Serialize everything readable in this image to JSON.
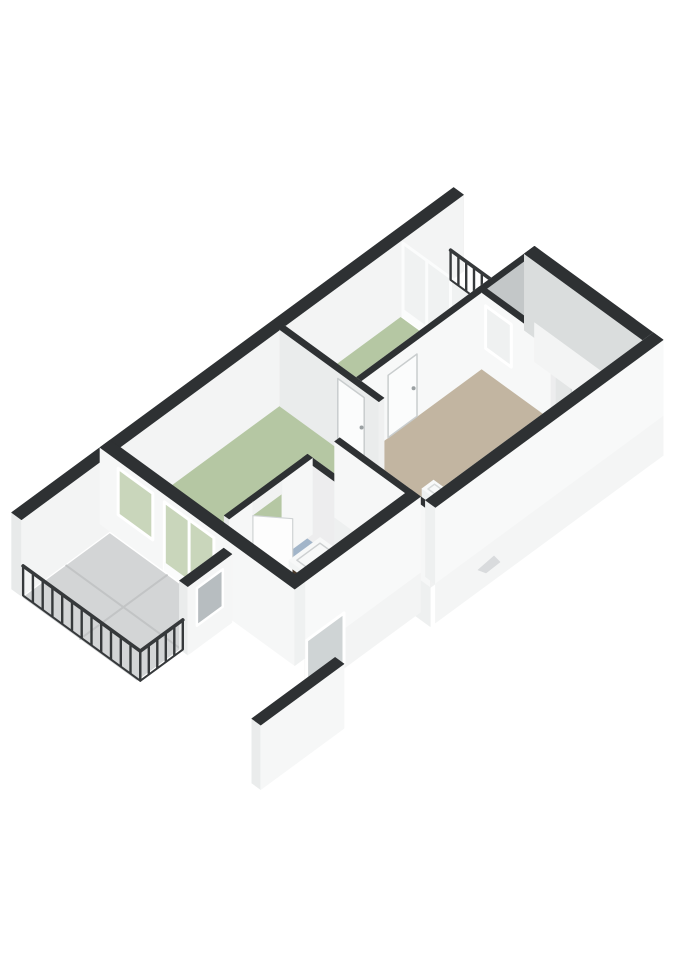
{
  "meta": {
    "description": "3D isometric floor plan render of an apartment, no text labels",
    "canvas": {
      "width": 679,
      "height": 960
    },
    "background": "#ffffff"
  },
  "palette": {
    "wall_top_dark": "#2e3133",
    "wall_white": "#f7f8f8",
    "wall_shadow": "#c3c7c8",
    "floor_green": "#b5c7a3",
    "floor_green_dark": "#aec29c",
    "floor_blue": "#a2b5c9",
    "floor_tan": "#c2b5a1",
    "floor_tile_gray": "#d3d5d6",
    "glass_green": "#c9d6bb",
    "railing_dark": "#36393b",
    "cabinet_brown": "#3b2f24",
    "fixture_white": "#f2f4f4"
  },
  "rooms": [
    {
      "id": "living-room",
      "floor_color": "#b5c7a3"
    },
    {
      "id": "bedroom-middle",
      "floor_color": "#b5c7a3"
    },
    {
      "id": "bedroom-right",
      "floor_color": "#b5c7a3"
    },
    {
      "id": "hallway",
      "floor_color": "#c2b5a1"
    },
    {
      "id": "bathroom",
      "floor_color": "#a2b5c9"
    },
    {
      "id": "balcony-southwest",
      "floor_color": "#d3d5d6"
    },
    {
      "id": "balcony-north",
      "floor_color": "#dcdedd"
    }
  ],
  "projection": {
    "ox": 100,
    "oy": 524,
    "u": [
      34,
      -25
    ],
    "v": [
      33,
      24
    ],
    "z": 30
  },
  "scene": [
    {
      "t": "wall",
      "name": "nw-facade-wall",
      "u": [
        -2.6,
        10.4
      ],
      "v": [
        0,
        0.3
      ],
      "z": [
        0,
        2.55
      ],
      "f": {
        "se": "#f3f4f4",
        "sw": "#e8eaea",
        "ne": "#dfe2e3",
        "top": "#2e3133"
      }
    },
    {
      "t": "floor",
      "name": "balcony-north-floor",
      "rect": [
        8.7,
        0.3,
        10.05,
        2.45
      ],
      "fill": "#dcdedd"
    },
    {
      "t": "floor",
      "name": "bedroom-middle-floor",
      "rect": [
        5.3,
        0.3,
        8.55,
        2.45
      ],
      "fill": "#b5c7a3"
    },
    {
      "t": "floor",
      "name": "bedroom-right-floor",
      "rect": [
        8.85,
        2.6,
        10.1,
        4.55
      ],
      "fill": "#b5c7a3"
    },
    {
      "t": "floor",
      "name": "living-room-floor",
      "rect": [
        0.3,
        0.3,
        5.0,
        3.3
      ],
      "fill": "#b5c7a3"
    },
    {
      "t": "floor",
      "name": "living-strip-floor",
      "rect": [
        2.9,
        3.3,
        3.55,
        5.6
      ],
      "fill": "#aec29c"
    },
    {
      "t": "floor",
      "name": "hallway-floor",
      "pts": [
        [
          5.1,
          2.6
        ],
        [
          8.7,
          2.6
        ],
        [
          8.7,
          6.05
        ],
        [
          3.7,
          6.05
        ],
        [
          3.7,
          3.45
        ],
        [
          5.1,
          3.45
        ]
      ],
      "fill": "#c2b5a1"
    },
    {
      "t": "floor",
      "name": "closet-floor",
      "rect": [
        8.85,
        4.7,
        10.1,
        6.05
      ],
      "fill": "#d0d2d1"
    },
    {
      "t": "floor",
      "name": "balcony-sw-floor",
      "rect": [
        -2.6,
        0.35,
        -0.05,
        3.8
      ],
      "fill": "#d3d5d6"
    },
    {
      "t": "line3",
      "name": "balcony-tile-seam-1",
      "pts": [
        [
          -1.33,
          0.35,
          0
        ],
        [
          -1.33,
          3.8,
          0
        ]
      ],
      "stroke": "#c2c4c5",
      "w": 2
    },
    {
      "t": "line3",
      "name": "balcony-tile-seam-2",
      "pts": [
        [
          -2.6,
          2.08,
          0
        ],
        [
          -0.05,
          2.08,
          0
        ]
      ],
      "stroke": "#c2c4c5",
      "w": 2
    },
    {
      "t": "floor",
      "name": "bathroom-floor",
      "rect": [
        0.45,
        3.45,
        2.75,
        5.6
      ],
      "fill": "#a2b5c9"
    },
    {
      "t": "floor",
      "name": "duct-shaft",
      "pts": [
        [
          2.3,
          4.05
        ],
        [
          2.75,
          4.05
        ],
        [
          2.75,
          4.6
        ],
        [
          2.05,
          4.6
        ],
        [
          2.05,
          4.32
        ],
        [
          2.3,
          4.32
        ]
      ],
      "fill": "#2e3133"
    },
    {
      "t": "glasswall",
      "name": "glazed-wall-middle-bedroom",
      "plane": "u",
      "at": 8.62,
      "r": [
        0.3,
        2.45
      ],
      "z": [
        0,
        2.42
      ],
      "fill": "#f0f2f2",
      "frame": "#fbfcfc",
      "mull": [
        1.02,
        1.74
      ],
      "base": 0.22
    },
    {
      "t": "rail",
      "name": "balcony-north-railing",
      "a": [
        10.0,
        0.32
      ],
      "b": [
        10.0,
        2.45
      ],
      "h": 1.05,
      "posts": 9,
      "color": "#36393b"
    },
    {
      "t": "wall",
      "name": "bedroom-right-nw-wall",
      "u": [
        8.7,
        10.4
      ],
      "v": [
        2.45,
        2.6
      ],
      "z": [
        0,
        2.55
      ],
      "f": {
        "nw": "#f4f5f5",
        "se": "#c3c7c8",
        "top": "#2e3133"
      }
    },
    {
      "t": "wall",
      "name": "bedroom-right-sw-wall",
      "u": [
        8.7,
        8.85
      ],
      "v": [
        2.45,
        4.7
      ],
      "z": [
        0,
        2.55
      ],
      "f": {
        "sw": "#f7f8f8",
        "top": "#2e3133"
      }
    },
    {
      "t": "win",
      "name": "bedroom-right-window",
      "plane": "u",
      "at": 8.7,
      "r": [
        2.72,
        3.5
      ],
      "z": [
        0.78,
        2.2
      ],
      "fill": "#eff1f1",
      "frame": "#ffffff",
      "fw": 3
    },
    {
      "t": "wall",
      "name": "middle-hallway-wall",
      "u": [
        5.15,
        8.7
      ],
      "v": [
        2.45,
        2.6
      ],
      "z": [
        0,
        2.55
      ],
      "f": {
        "nw": "#ededee",
        "se": "#f7f8f8",
        "top": "#2e3133"
      }
    },
    {
      "t": "win",
      "name": "door-middle-bedroom",
      "plane": "v",
      "at": 2.6,
      "r": [
        5.95,
        6.8
      ],
      "z": [
        0,
        2.08
      ],
      "fill": "#fbfcfc",
      "frame": "#c9cdce",
      "fw": 1.5
    },
    {
      "t": "dot",
      "name": "door-handle-middle",
      "p": [
        6.7,
        2.6,
        1.02
      ],
      "r": 2,
      "fill": "#9aa0a2"
    },
    {
      "t": "wall",
      "name": "living-hallway-wall",
      "u": [
        5.0,
        5.15
      ],
      "v": [
        0.3,
        3.3
      ],
      "z": [
        0,
        2.55
      ],
      "f": {
        "sw": "#eaecec",
        "ne": "#f7f8f8",
        "se": "#eff0f0",
        "top": "#2e3133"
      }
    },
    {
      "t": "win",
      "name": "door-living-room",
      "plane": "u",
      "at": 5.15,
      "r": [
        1.9,
        2.7
      ],
      "z": [
        0,
        2.08
      ],
      "fill": "#fbfcfc",
      "frame": "#c9cdce",
      "fw": 1.5
    },
    {
      "t": "dot",
      "name": "door-handle-living",
      "p": [
        5.15,
        2.62,
        1.02
      ],
      "r": 2,
      "fill": "#9aa0a2"
    },
    {
      "t": "wall",
      "name": "bathroom-ne-wall",
      "u": [
        2.75,
        2.9
      ],
      "v": [
        3.3,
        5.6
      ],
      "z": [
        0,
        2.55
      ],
      "f": {
        "ne": "#f5f6f6",
        "sw": "#ededee",
        "top": "#2e3133"
      }
    },
    {
      "t": "wall",
      "name": "bathroom-nw-wall-a",
      "u": [
        0.45,
        1.15
      ],
      "v": [
        3.3,
        3.45
      ],
      "z": [
        0,
        2.55
      ],
      "f": {
        "se": "#f6f7f7",
        "sw": "#e6e8e8",
        "top": "#2e3133"
      }
    },
    {
      "t": "wall",
      "name": "bathroom-nw-wall-b",
      "u": [
        2.0,
        2.9
      ],
      "v": [
        3.3,
        3.45
      ],
      "z": [
        0,
        2.55
      ],
      "f": {
        "se": "#f6f7f7",
        "top": "#2e3133"
      }
    },
    {
      "t": "wall",
      "name": "bathroom-door-header",
      "u": [
        1.15,
        2.0
      ],
      "v": [
        3.3,
        3.45
      ],
      "z": [
        2.1,
        2.55
      ],
      "f": {
        "se": "#f1f2f2",
        "top": "#2e3133"
      }
    },
    {
      "t": "arc",
      "name": "bathroom-door-arc",
      "c": [
        1.15,
        3.45
      ],
      "r": 0.85,
      "a0": 8,
      "a1": 54,
      "stroke": "#c7cbcc"
    },
    {
      "t": "leaf",
      "name": "bathroom-door-leaf",
      "hinge": [
        1.15,
        3.45
      ],
      "end": [
        1.67,
        4.12
      ],
      "z": [
        0,
        2.08
      ],
      "fill": "#fdfdfd",
      "stroke": "#cfd3d4"
    },
    {
      "t": "wall",
      "name": "sink-cabinet",
      "u": [
        1.5,
        2.3
      ],
      "v": [
        4.3,
        4.78
      ],
      "z": [
        0.22,
        0.78
      ],
      "f": {
        "sw": "#4a3a2b",
        "se": "#3b2f24",
        "ne": "#332921",
        "top": "#2a211a"
      }
    },
    {
      "t": "wall",
      "name": "sink-basin",
      "u": [
        1.44,
        2.36
      ],
      "v": [
        4.24,
        4.82
      ],
      "z": [
        0.78,
        0.98
      ],
      "f": {
        "sw": "#f2f4f4",
        "se": "#e9ebeb",
        "ne": "#e0e2e2",
        "top": "#f7f8f8"
      }
    },
    {
      "t": "line3",
      "name": "sink-basin-rim",
      "pts": [
        [
          1.56,
          4.36,
          0.98
        ],
        [
          2.24,
          4.36,
          0.98
        ],
        [
          2.24,
          4.7,
          0.98
        ],
        [
          1.56,
          4.7,
          0.98
        ],
        [
          1.56,
          4.36,
          0.98
        ]
      ],
      "stroke": "#cdd0d1",
      "w": 1.5
    },
    {
      "t": "wall",
      "name": "toilet",
      "u": [
        5.18,
        5.52
      ],
      "v": [
        4.42,
        4.84
      ],
      "z": [
        0,
        0.4
      ],
      "f": {
        "sw": "#eef0f0",
        "se": "#e7eaea",
        "ne": "#e2e5e5",
        "top": "#f8f9f9"
      }
    },
    {
      "t": "line3",
      "name": "toilet-seat",
      "pts": [
        [
          5.26,
          4.52,
          0.4
        ],
        [
          5.45,
          4.52,
          0.4
        ],
        [
          5.45,
          4.76,
          0.4
        ],
        [
          5.26,
          4.76,
          0.4
        ],
        [
          5.26,
          4.52,
          0.4
        ]
      ],
      "stroke": "#d7dada",
      "w": 1.5
    },
    {
      "t": "wall",
      "name": "step-wall",
      "u": [
        3.55,
        3.7
      ],
      "v": [
        3.45,
        6.35
      ],
      "z": [
        0,
        2.55
      ],
      "f": {
        "sw": "#f6f7f7",
        "ne": "#e9ebeb",
        "se": "#f0f1f1",
        "top": "#2e3133"
      },
      "skirt": {
        "faces": [
          "sw"
        ],
        "z": -1.3,
        "fill": "#eef0f0"
      }
    },
    {
      "t": "wall",
      "name": "hallway-closet-wall",
      "u": [
        8.7,
        8.85
      ],
      "v": [
        4.7,
        6.05
      ],
      "z": [
        0,
        2.55
      ],
      "f": {
        "sw": "#f5f6f6",
        "top": "#2e3133"
      }
    },
    {
      "t": "wall",
      "name": "bedroom-right-se-wall",
      "u": [
        8.85,
        10.1
      ],
      "v": [
        4.55,
        4.7
      ],
      "z": [
        0,
        2.55
      ],
      "f": {
        "nw": "#ededee",
        "se": "#e4e6e6",
        "top": "#2e3133"
      }
    },
    {
      "t": "win",
      "name": "door-closet",
      "plane": "v",
      "at": 4.7,
      "r": [
        9.3,
        10.02
      ],
      "z": [
        0,
        2.05
      ],
      "fill": "#f3f5f5",
      "frame": "#d3d6d7",
      "fw": 1.5
    },
    {
      "t": "wall",
      "name": "ne-end-wall",
      "u": [
        10.1,
        10.4
      ],
      "v": [
        2.45,
        6.35
      ],
      "z": [
        0,
        2.55
      ],
      "f": {
        "sw": "#dadddd",
        "ne": "#f8f9f9",
        "se": "#f4f5f5",
        "top": "#2e3133"
      },
      "skirt": {
        "faces": [
          "ne",
          "se"
        ],
        "z": -1.3,
        "fill": "#f3f4f4"
      }
    },
    {
      "t": "wall",
      "name": "ne-facade-wall",
      "u": [
        3.7,
        10.4
      ],
      "v": [
        6.05,
        6.35
      ],
      "z": [
        0,
        2.55
      ],
      "f": {
        "nw": "#f2f3f3",
        "se": "#f8f9f9",
        "sw": "#eef0f0",
        "top": "#2e3133"
      },
      "skirt": {
        "faces": [
          "se"
        ],
        "z": -1.3,
        "fill": "#f4f5f5"
      }
    },
    {
      "t": "wall",
      "name": "sw-facade-wall",
      "u": [
        0.3,
        3.7
      ],
      "v": [
        5.6,
        5.9
      ],
      "z": [
        0,
        2.55
      ],
      "f": {
        "se": "#f8f9f9",
        "sw": "#eef0f0",
        "top": "#2e3133"
      },
      "skirt": {
        "faces": [
          "se"
        ],
        "z": -1.3,
        "fill": "#f3f4f4"
      }
    },
    {
      "t": "win",
      "name": "downstairs-window",
      "plane": "v",
      "at": 5.9,
      "r": [
        0.35,
        1.45
      ],
      "z": [
        -1.15,
        0.55
      ],
      "fill": "#cfd4d5",
      "frame": "#ffffff",
      "fw": 3
    },
    {
      "t": "wall",
      "name": "lower-level-stub-wall",
      "u": [
        -1.0,
        1.45
      ],
      "v": [
        5.63,
        5.9
      ],
      "z": [
        -3.3,
        -1.15
      ],
      "f": {
        "se": "#f6f7f7",
        "sw": "#eaecec",
        "top": "#2e3133"
      }
    },
    {
      "t": "wall",
      "name": "sw-end-wall",
      "u": [
        0,
        0.3
      ],
      "v": [
        0,
        5.9
      ],
      "z": [
        0,
        2.55
      ],
      "f": {
        "sw": "#f6f7f7",
        "se": "#eff1f1",
        "top": "#2e3133"
      }
    },
    {
      "t": "win",
      "name": "living-sw-window",
      "plane": "u",
      "at": 0,
      "r": [
        0.55,
        1.6
      ],
      "z": [
        0.75,
        2.3
      ],
      "fill": "#c9d6bb",
      "frame": "#ffffff",
      "fw": 3
    },
    {
      "t": "glasswall",
      "name": "balcony-glass-doors",
      "plane": "u",
      "at": 0,
      "r": [
        1.95,
        3.45
      ],
      "z": [
        0.02,
        2.3
      ],
      "fill": "#c9d6bb",
      "frame": "#ffffff",
      "mull": [
        2.7
      ],
      "base": 0.26
    },
    {
      "t": "wall",
      "name": "balcony-screen-wall",
      "u": [
        -1.35,
        -0.05
      ],
      "v": [
        3.8,
        4.05
      ],
      "z": [
        0,
        2.28
      ],
      "f": {
        "nw": "#eff1f1",
        "se": "#f5f6f6",
        "sw": "#eaecec",
        "top": "#2e3133"
      }
    },
    {
      "t": "win",
      "name": "screen-wall-window",
      "plane": "v",
      "at": 4.05,
      "r": [
        -1.08,
        -0.32
      ],
      "z": [
        0.75,
        2.0
      ],
      "fill": "#b7bdc0",
      "frame": "#ffffff",
      "fw": 2.5
    },
    {
      "t": "rail",
      "name": "balcony-sw-railing",
      "a": [
        -2.6,
        0.35
      ],
      "b": [
        -2.6,
        3.9
      ],
      "h": 1.05,
      "posts": 12,
      "color": "#36393b"
    },
    {
      "t": "rail",
      "name": "balcony-se-railing",
      "a": [
        -2.6,
        3.9
      ],
      "b": [
        -1.35,
        3.9
      ],
      "h": 1.05,
      "posts": 5,
      "color": "#36393b"
    },
    {
      "t": "mark",
      "name": "pointer-marker",
      "pts": [
        [
          478,
          570
        ],
        [
          494,
          556
        ],
        [
          500,
          562
        ],
        [
          486,
          573
        ]
      ],
      "fill": "#d9dbdd"
    }
  ]
}
